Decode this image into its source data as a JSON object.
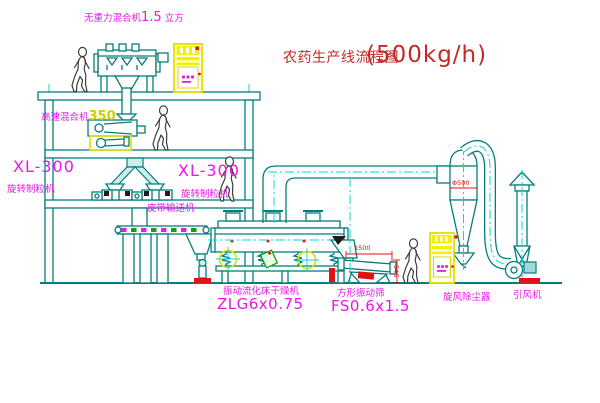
{
  "title": {
    "text": "农药生产线流程图",
    "capacity": "(500kg/h)"
  },
  "equipment_labels": {
    "gravity_free_mixer": {
      "name": "无重力混合机",
      "size": "1.5",
      "unit": "立方"
    },
    "high_speed_mixer": {
      "name": "高速混合机",
      "model": "350"
    },
    "granulator_left": {
      "model": "XL-300",
      "name": "旋转制粒机"
    },
    "granulator_right": {
      "model": "XL-300",
      "name": "旋转制粒机"
    },
    "belt_conveyor": {
      "name": "皮带输送机"
    },
    "fluid_bed_dryer": {
      "name": "振动流化床干燥机",
      "model": "ZLG6x0.75"
    },
    "vibrating_screen": {
      "name": "方形振动筛",
      "model": "FS0.6x1.5"
    },
    "cyclone": {
      "name": "旋风除尘器"
    },
    "induced_draft_fan": {
      "name": "引风机"
    }
  },
  "dimensions": {
    "screen_length": "1500",
    "screen_height": "545",
    "cyclone_diameter": "Φ500"
  },
  "colors": {
    "line_teal": "#067d7d",
    "centerline_cyan": "#00d9d9",
    "label_magenta": "#e818e8",
    "title_red": "#c22a2a",
    "dimension_red": "#dd1111",
    "cabinet_yellow": "#e0e000"
  }
}
